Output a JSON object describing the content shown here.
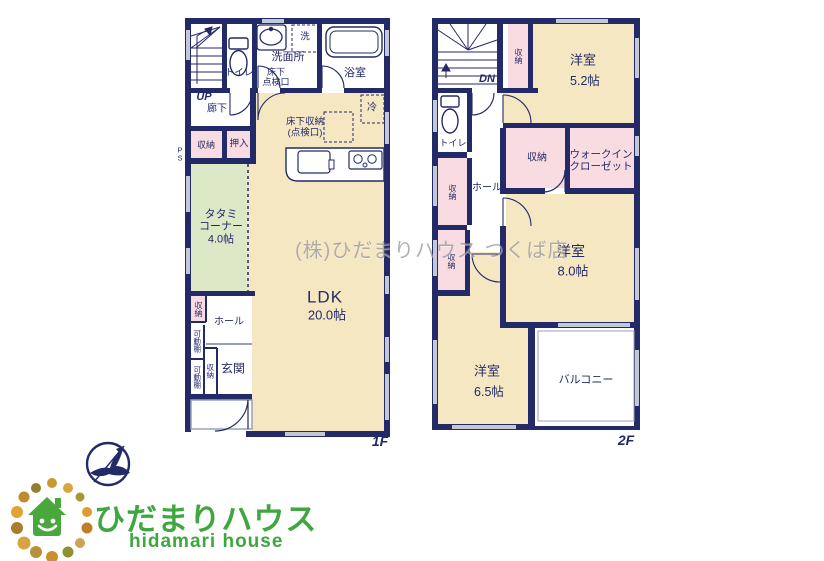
{
  "palette": {
    "wall": "#232a68",
    "room_beige": "#f6e7c3",
    "room_pink": "#f8dce1",
    "room_green": "#dce8c6",
    "window_gray": "#c3c8d6",
    "brand_green": "#3fa73f",
    "watermark_gray": "#7d7d84"
  },
  "watermark": "(株)ひだまりハウス つくば店",
  "floor1": {
    "floor_label": "1F",
    "stairs_label": "UP",
    "rooms": {
      "hallway": "廊下",
      "toilet": "トイレ",
      "washroom": "洗面所",
      "washer": "洗",
      "underfloor_hatch": "床下\n点検口",
      "bath": "浴室",
      "fridge": "冷",
      "underfloor_storage": "床下収納\n(点検口)",
      "pipe_space": "P\nS",
      "storage_hall": "収納",
      "oshiire": "押入",
      "tatami": "タタミ\nコーナー\n4.0帖",
      "ldk_name": "LDK",
      "ldk_size": "20.0帖",
      "storage_entry_upper": "収納",
      "hall": "ホール",
      "shelf1": "可動棚",
      "shelf2": "可動棚",
      "storage_entry_lower": "収納",
      "entrance": "玄関"
    }
  },
  "floor2": {
    "floor_label": "2F",
    "stairs_label": "DN",
    "rooms": {
      "closet_strip": "収納",
      "bedroom1_name": "洋室",
      "bedroom1_size": "5.2帖",
      "toilet": "トイレ",
      "storage_left1": "収納",
      "storage_left2": "収納",
      "hall": "ホール",
      "storage_center": "収納",
      "walkin_closet": "ウォークイン\nクローゼット",
      "bedroom2_name": "洋室",
      "bedroom2_size": "8.0帖",
      "bedroom3_name": "洋室",
      "bedroom3_size": "6.5帖",
      "balcony": "バルコニー"
    }
  },
  "logo": {
    "brand_jp": "ひだまりハウス",
    "brand_en": "hidamari house",
    "green": "#3fa73f",
    "house_green": "#48a83c",
    "compass_navy": "#242a6e",
    "dots": [
      {
        "x": 52,
        "y": 483,
        "r": 5,
        "c": "#c79a2e"
      },
      {
        "x": 68,
        "y": 488,
        "r": 5,
        "c": "#d9a63a"
      },
      {
        "x": 80,
        "y": 497,
        "r": 4.5,
        "c": "#a3992f"
      },
      {
        "x": 87,
        "y": 512,
        "r": 5,
        "c": "#e09a2f"
      },
      {
        "x": 87,
        "y": 528,
        "r": 5.5,
        "c": "#c07e28"
      },
      {
        "x": 80,
        "y": 543,
        "r": 5,
        "c": "#cfa254"
      },
      {
        "x": 68,
        "y": 552,
        "r": 5.5,
        "c": "#8f8f35"
      },
      {
        "x": 52,
        "y": 557,
        "r": 6,
        "c": "#ca8f2a"
      },
      {
        "x": 36,
        "y": 552,
        "r": 6,
        "c": "#b9913a"
      },
      {
        "x": 24,
        "y": 543,
        "r": 6.5,
        "c": "#d8a441"
      },
      {
        "x": 17,
        "y": 528,
        "r": 6,
        "c": "#a87e2b"
      },
      {
        "x": 17,
        "y": 512,
        "r": 6,
        "c": "#e0a433"
      },
      {
        "x": 24,
        "y": 497,
        "r": 5.5,
        "c": "#c28a2e"
      },
      {
        "x": 36,
        "y": 488,
        "r": 5,
        "c": "#947f2e"
      }
    ]
  }
}
